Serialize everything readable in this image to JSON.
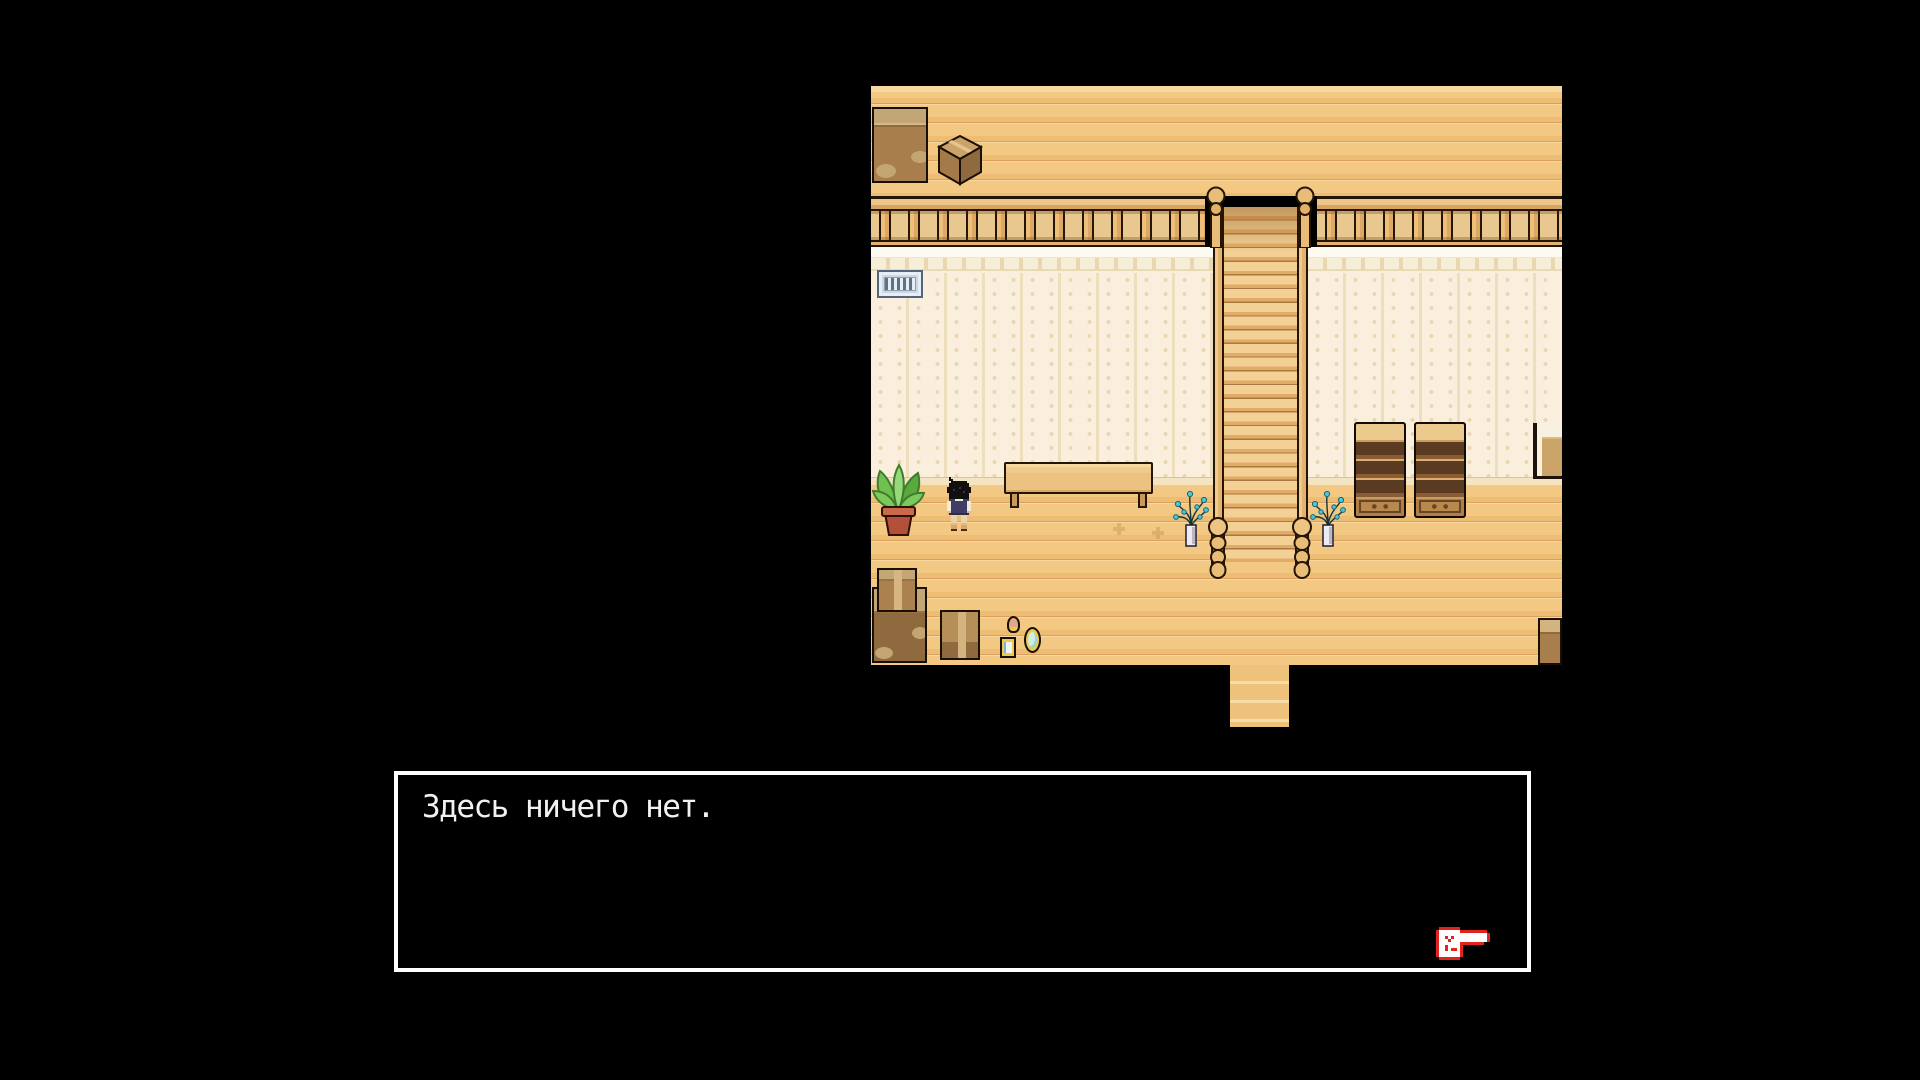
{
  "scene": {
    "type": "pixel-rpg-interior",
    "location": "upstairs-hallway-with-staircase"
  },
  "dialogue": {
    "text": "Здесь ничего нет.",
    "cursor_icon": "red-pointing-hand",
    "border_color": "#ffffff",
    "background_color": "#000000",
    "text_color": "#f1f1f1"
  },
  "room": {
    "objects": [
      "cardboard-crate-tall",
      "cardboard-crate-cube",
      "stair-railing",
      "staircase-up",
      "staircase-down-exit",
      "wall-vent-grate",
      "wooden-bench",
      "potted-plant",
      "player-character",
      "stair-post-vase-left",
      "stair-post-vase-right",
      "bookshelf-left",
      "bookshelf-right",
      "desk-edge",
      "box-stack",
      "cardboard-box",
      "egg-ornament",
      "photo-frame",
      "hand-mirror",
      "crate-bottom-right"
    ]
  },
  "palette": {
    "background": "#000000",
    "floor_wood": "#f0c47e",
    "wall_cream": "#f9efdc",
    "furniture_wood": "#a87f4d",
    "plant_green": "#6fc04f",
    "vase_leaf_teal": "#49c8d8",
    "vent_blue": "#cdd7e2",
    "cursor_red": "#e0241a"
  }
}
